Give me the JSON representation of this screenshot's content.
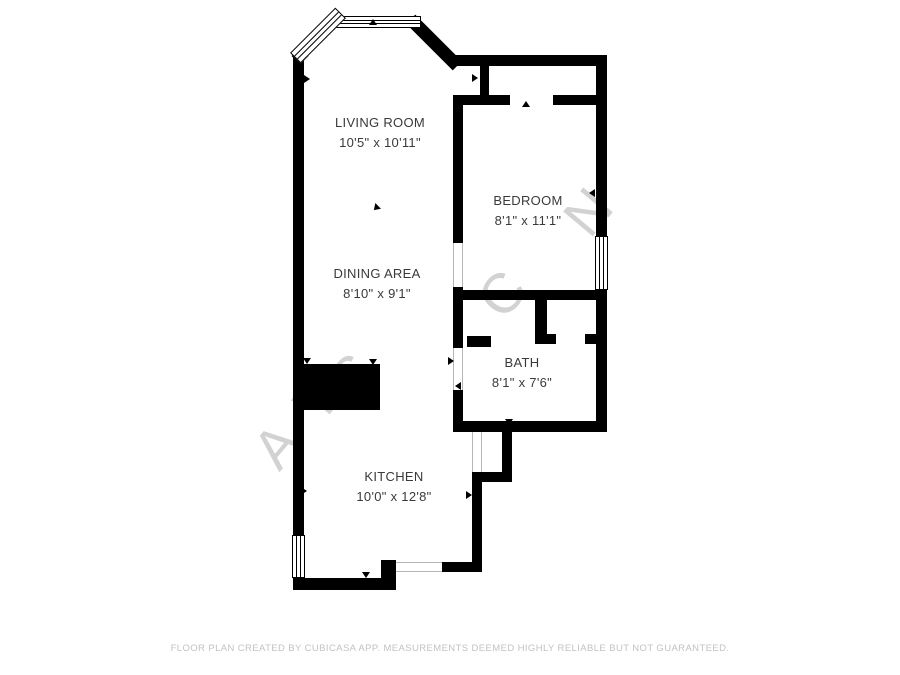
{
  "floor_plan": {
    "rooms": [
      {
        "name": "LIVING ROOM",
        "dimensions": "10'5\" x 10'11\""
      },
      {
        "name": "BEDROOM",
        "dimensions": "8'1\" x 11'1\""
      },
      {
        "name": "DINING AREA",
        "dimensions": "8'10\" x 9'1\""
      },
      {
        "name": "BATH",
        "dimensions": "8'1\" x 7'6\""
      },
      {
        "name": "KITCHEN",
        "dimensions": "10'0\" x 12'8\""
      }
    ],
    "watermark_fragments": [
      "A",
      "Y",
      "S",
      "C",
      "N"
    ],
    "footer_text": "FLOOR PLAN CREATED BY CUBICASA APP. MEASUREMENTS DEEMED HIGHLY RELIABLE BUT NOT GUARANTEED.",
    "colors": {
      "wall": "#000000",
      "background": "#ffffff",
      "room_label": "#3a3a3a",
      "watermark": "#c7c7c7",
      "footer": "#c2c2c2"
    }
  }
}
